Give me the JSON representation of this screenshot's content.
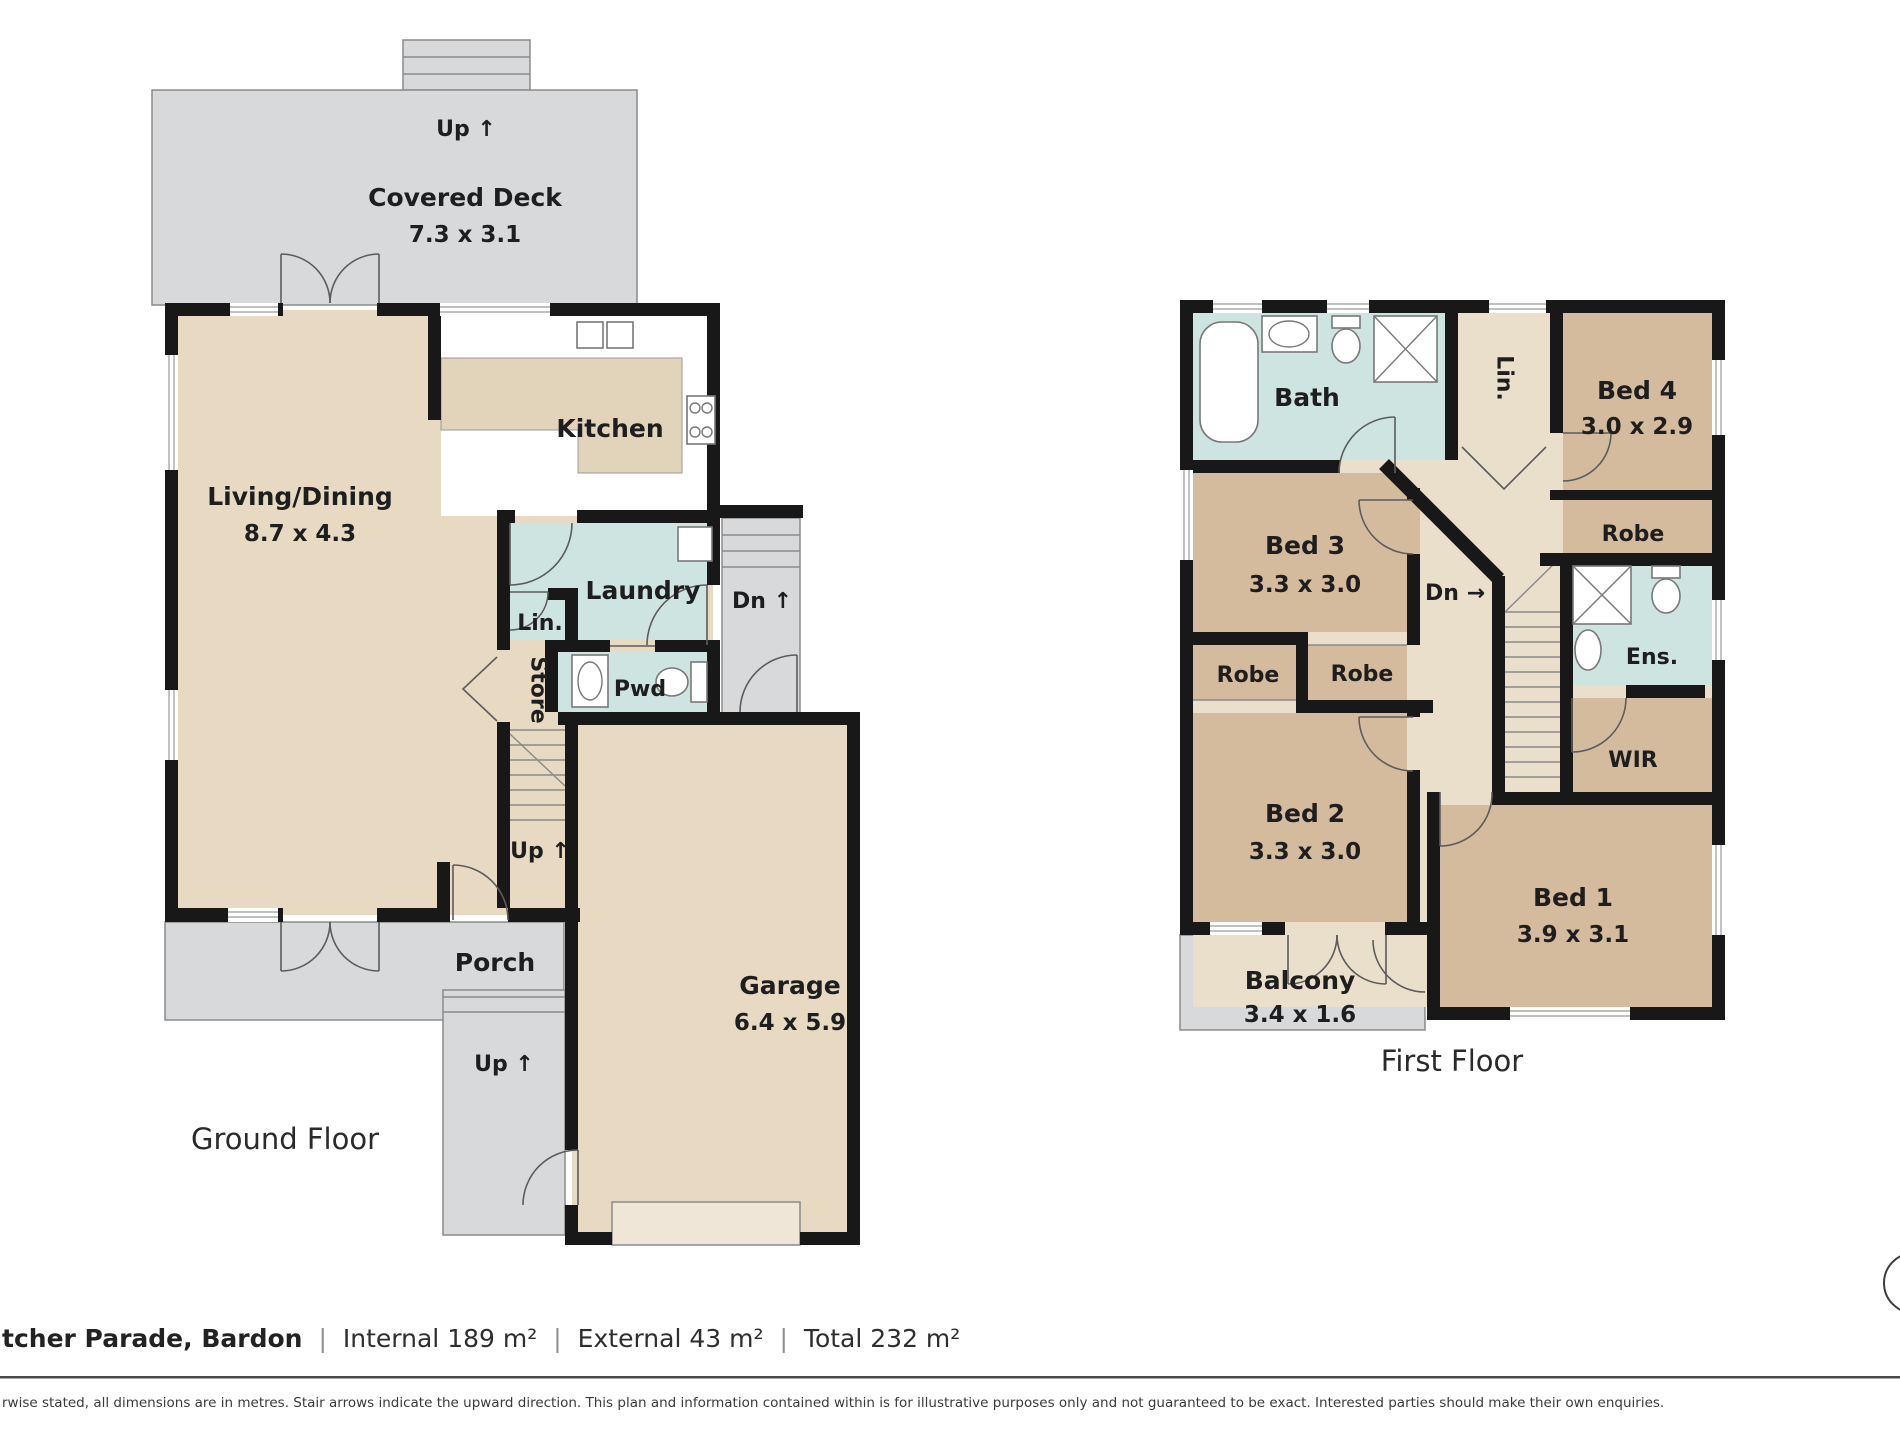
{
  "ground_floor": {
    "caption": "Ground Floor",
    "deck_stairs_up": "Up ↑",
    "covered_deck": "Covered Deck",
    "covered_deck_dims": "7.3 x 3.1",
    "kitchen": "Kitchen",
    "living_dining": "Living/Dining",
    "living_dining_dims": "8.7 x 4.3",
    "laundry": "Laundry",
    "side_stairs_down": "Dn ↑",
    "linen": "Lin.",
    "powder": "Pwd",
    "store": "Store",
    "internal_stairs_up": "Up ↑",
    "porch": "Porch",
    "front_steps_up": "Up ↑",
    "garage": "Garage",
    "garage_dims": "6.4 x 5.9"
  },
  "first_floor": {
    "caption": "First Floor",
    "bath": "Bath",
    "linen": "Lin.",
    "bed4": "Bed 4",
    "bed4_dims": "3.0 x 2.9",
    "robe_bed4": "Robe",
    "bed3": "Bed 3",
    "bed3_dims": "3.3 x 3.0",
    "stairs_down": "Dn →",
    "ensuite": "Ens.",
    "robe_left": "Robe",
    "robe_right": "Robe",
    "wir": "WIR",
    "bed2": "Bed 2",
    "bed2_dims": "3.3 x 3.0",
    "bed1": "Bed 1",
    "bed1_dims": "3.9 x 3.1",
    "balcony": "Balcony",
    "balcony_dims": "3.4 x 1.6"
  },
  "footer": {
    "address": "tcher Parade, Bardon",
    "separator": "|",
    "internal": "Internal 189 m²",
    "external": "External 43 m²",
    "total": "Total 232 m²",
    "disclaimer": "rwise stated, all dimensions are in metres. Stair arrows indicate the upward direction. This plan and information contained within is for illustrative purposes only and not guaranteed to be exact. Interested parties should make their own enquiries."
  },
  "colors": {
    "wall": "#181818",
    "floor_tan": "#e7d9c2",
    "bedroom_tan": "#d4bb9e",
    "hall_tan": "#eadfca",
    "wet_area_teal": "#cde4e1",
    "outdoor_grey": "#d8d9db",
    "garage_door": "#efe6d7"
  }
}
